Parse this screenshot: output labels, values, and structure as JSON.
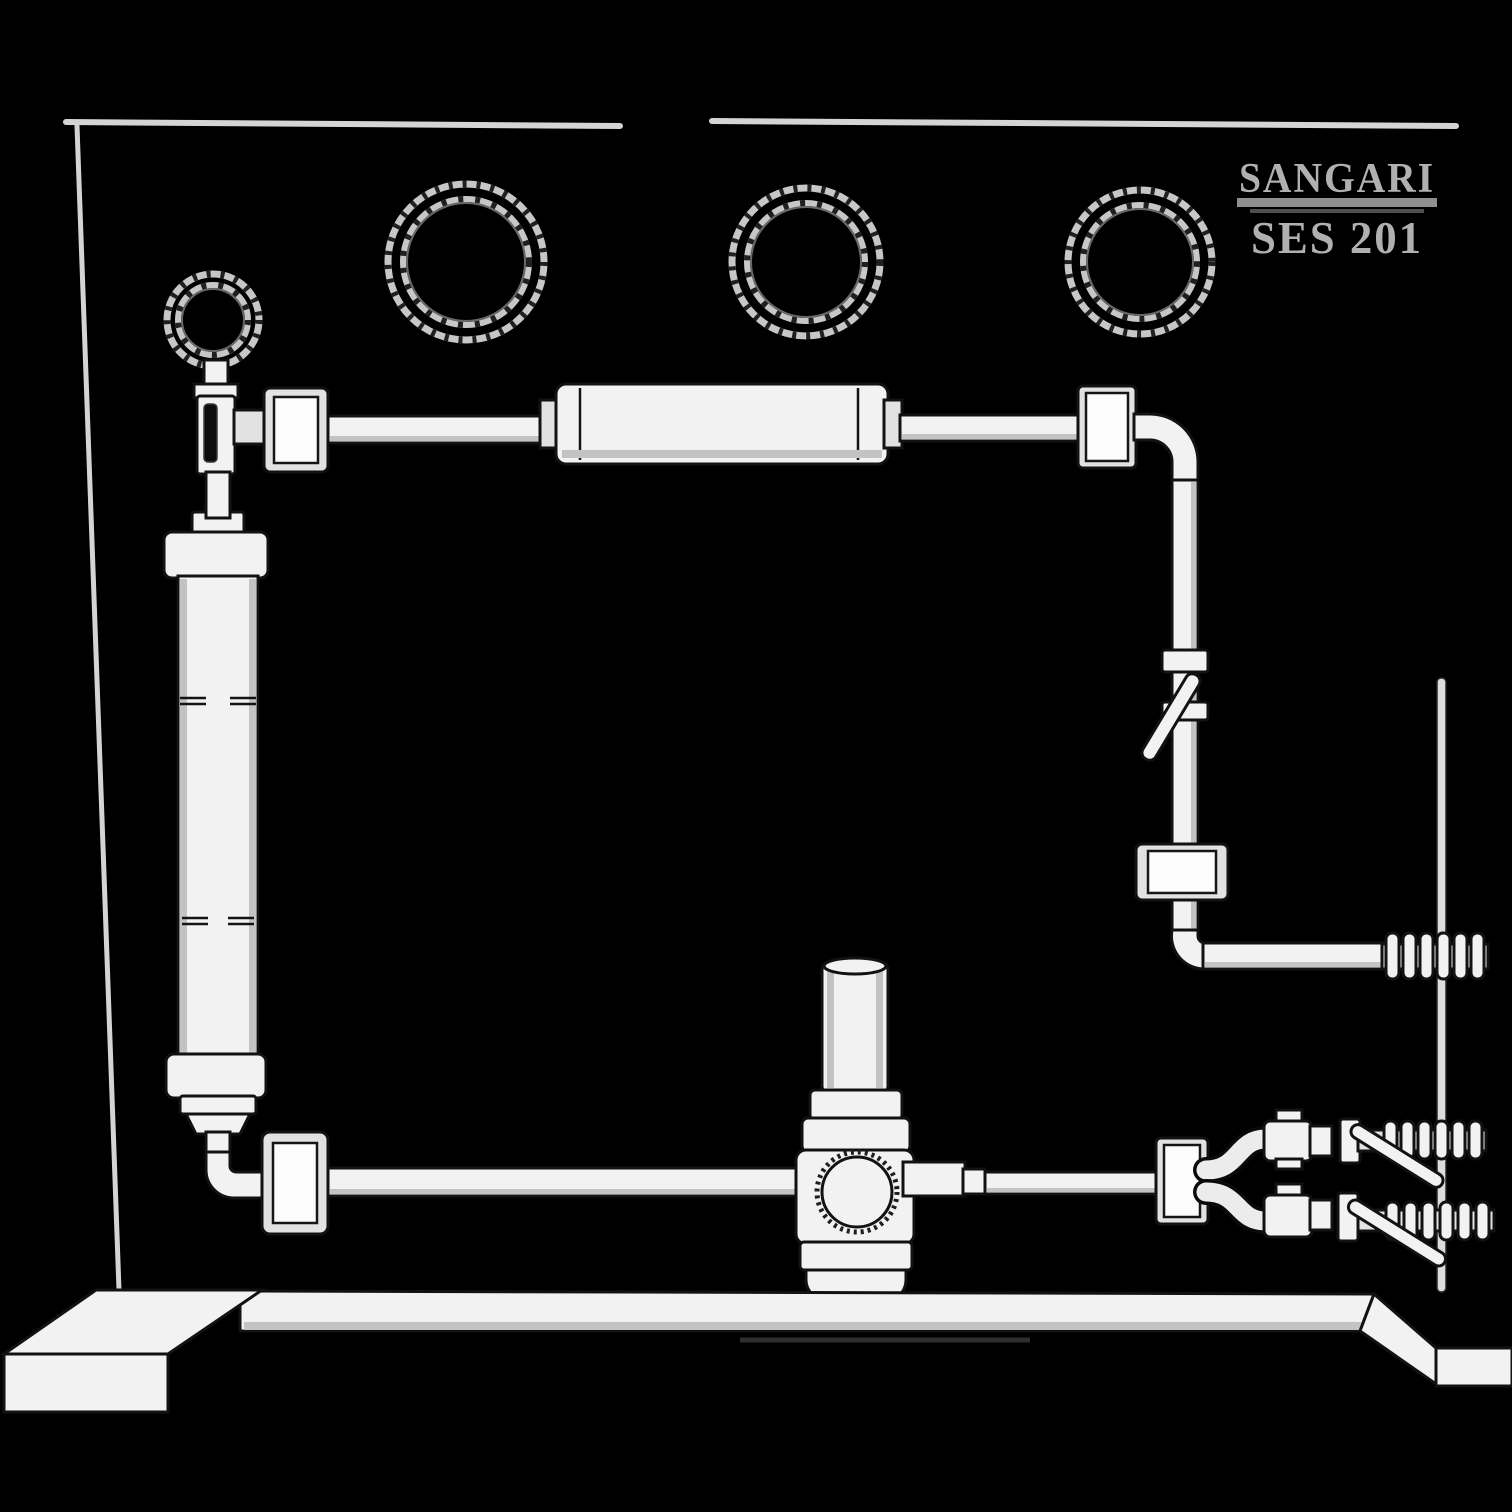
{
  "title": "SANGARI SES 201 laboratory training panel illustration",
  "colors": {
    "background": "#000000",
    "part_fill": "#f2f2f2",
    "part_outline": "#121212",
    "frame_line": "#d4d4d4",
    "text": "#b0b0b0"
  },
  "branding": {
    "brand": "SANGARI",
    "model": "SES 201"
  },
  "components": {
    "gauges": [
      "pressure-gauge-small-left",
      "pressure-gauge-1",
      "pressure-gauge-2",
      "pressure-gauge-3"
    ],
    "vessels": [
      "horizontal-cylinder-vessel",
      "vertical-column-vessel"
    ],
    "valves": [
      "left-gauge-valve",
      "right-line-valve",
      "center-regulator",
      "outlet-valve-upper",
      "outlet-valve-lower"
    ],
    "fittings": [
      "panel-fitting-top-left",
      "panel-fitting-top-right",
      "panel-fitting-right",
      "panel-fitting-bottom-left",
      "panel-fitting-bottom-right"
    ],
    "connectors": [
      "hose-barb-right",
      "hose-barb-outlet-upper",
      "hose-barb-outlet-lower"
    ],
    "stand": [
      "base-bar",
      "left-foot",
      "right-foot",
      "right-support-rod",
      "panel-frame"
    ]
  }
}
